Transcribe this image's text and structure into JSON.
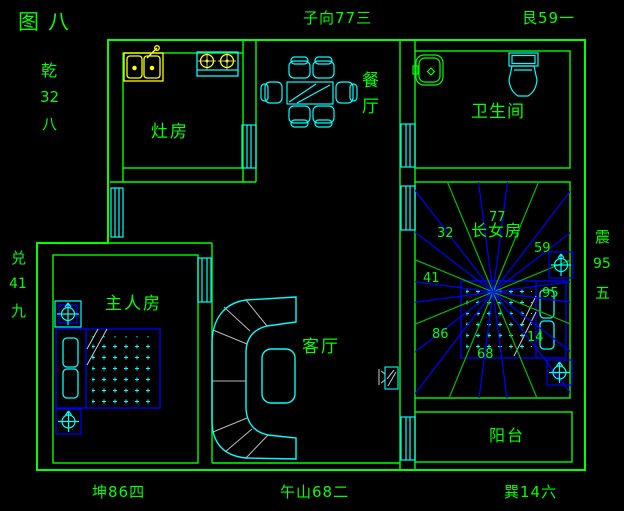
{
  "figure_title": "图八",
  "perimeter_labels": {
    "top_center": "子向77三",
    "top_right": "艮59一",
    "left_upper": [
      "乾",
      "32",
      "八"
    ],
    "left_middle": [
      "兑",
      "41",
      "九"
    ],
    "right_middle": [
      "震",
      "95",
      "五"
    ],
    "bottom_left": "坤86四",
    "bottom_center": "午山68二",
    "bottom_right": "巽14六"
  },
  "rooms": {
    "kitchen": {
      "label": "灶房"
    },
    "dining": {
      "label": "餐厅"
    },
    "bathroom": {
      "label": "卫生间"
    },
    "master_bedroom": {
      "label": "主人房"
    },
    "living_room": {
      "label": "客厅"
    },
    "daughter_room": {
      "label": "长女房"
    },
    "balcony": {
      "label": "阳台"
    }
  },
  "daughter_room_sector_numbers": {
    "nw": "32",
    "n": "77",
    "ne": "59",
    "w": "41",
    "e": "95",
    "sw": "86",
    "s": "68",
    "se": "14"
  },
  "compass": {
    "cx": 493,
    "cy": 292,
    "ray_count": 24,
    "step_deg": 15,
    "offset_deg": 7.5,
    "green_every": 3,
    "ray_length": 215
  },
  "colors": {
    "background": "#000000",
    "wall_green": "#00ff00",
    "fixture_cyan": "#00ffff",
    "furniture_blue": "#0000ff",
    "sink_yellow": "#ffff00",
    "ray_blue": "#0000ff",
    "ray_green": "#00bb00",
    "divider_gray": "#b8b8b8",
    "text_green": "#00ff00"
  },
  "icons": {
    "compass_marker": "circle-with-crosshair",
    "window": "triple-striped-rect",
    "stove_burner": "circle-with-cross",
    "dot_mattress": "plus-dot-grid"
  }
}
